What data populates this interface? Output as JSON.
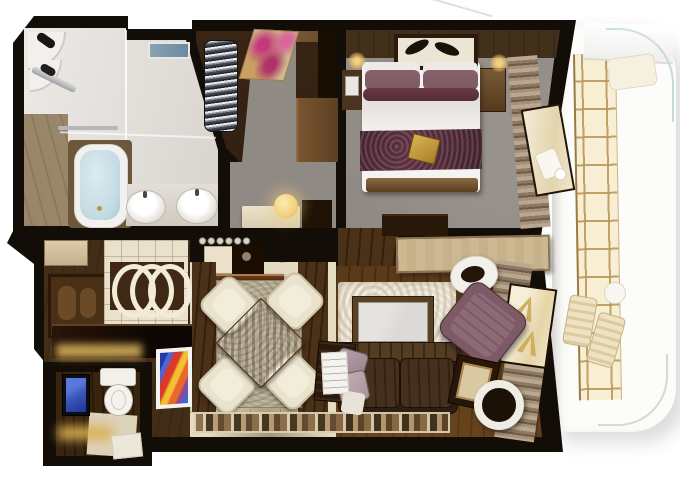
{
  "scene": {
    "description": "Top-down 3D rendered floor plan of a suite stateroom with private balcony; no text labels rendered",
    "background": "#ffffff"
  },
  "palette": {
    "wall": "#130d08",
    "marble": "#e9e5e1",
    "marble_dark": "#d8d3cd",
    "bath_wood": "#9a8668",
    "water": "#c3dae2",
    "closet_floor": "#2b1c10",
    "rug_pink": "#c23a78",
    "rug_gold": "#cdb78c",
    "carpet": "#908a85",
    "headwall": "#3b2a16",
    "bed_white": "#f5f3f0",
    "bed_runner": "#5d3040",
    "pillow_mauve": "#7d5b62",
    "sconce": "#f2d27c",
    "credenza": "#cdb894",
    "wood_floor": "#3a2715",
    "wood_floor_light": "#4a3118",
    "tile": "#e5dbc1",
    "tile_wall": "#eae1cd",
    "lattice_bg": "#3f2814",
    "cream": "#e9e2cd",
    "table_wood": "#7a5838",
    "sofa": "#2e1f12",
    "plum": "#7d5a66",
    "tv_screen": "#dcdad6",
    "balcony_gold": "#b9975a",
    "balcony_glass_bg": "#f8eed4",
    "deck_white": "#fcfcfa",
    "glow_gold": "#dcb65e",
    "wc_blue": "#3b55b8",
    "art_red": "#d93a2a",
    "art_blue": "#2438a8",
    "art_yellow": "#f2c12e",
    "mosaic_brown": "#8a6b46"
  },
  "rooms": [
    {
      "name": "master-bathroom",
      "label": "Master bathroom",
      "features": [
        "corner shower shelves",
        "shower head bar",
        "glass partition",
        "skylight",
        "bathtub",
        "double round sinks",
        "teak floor strip",
        "towel bar"
      ]
    },
    {
      "name": "walk-in-closet",
      "label": "Walk-in closet",
      "features": [
        "spiral clothes rack",
        "pink patterned rug",
        "wardrobe cabinet"
      ]
    },
    {
      "name": "entry-corridor",
      "label": "Entry corridor",
      "features": [
        "cream console",
        "glowing sphere lamp",
        "cabinet"
      ]
    },
    {
      "name": "master-bedroom",
      "label": "Master bedroom",
      "features": [
        "king bed with burgundy runner",
        "headboard wall",
        "ceiling leaf panel",
        "two wall sconces",
        "two nightstands",
        "foot dresser",
        "curtains",
        "balcony window"
      ]
    },
    {
      "name": "bar-kitchenette",
      "label": "Bar / kitchenette",
      "features": [
        "tan cabinet",
        "wood art panel",
        "tile wall with ring lattice",
        "buffet with espresso machine",
        "glossy bar counter with gold underglow",
        "colorful abstract artwork"
      ]
    },
    {
      "name": "dining-area",
      "label": "Dining area",
      "features": [
        "square walnut table rotated 45deg",
        "four cream chairs",
        "area rug",
        "mosaic runner rug"
      ]
    },
    {
      "name": "living-room",
      "label": "Living room",
      "features": [
        "stone TV wall with wall TV",
        "dark slatted sofa with mauve pillows",
        "plum armchair",
        "end table with framed art",
        "round tray table",
        "white desk chair",
        "curtains",
        "balcony window"
      ]
    },
    {
      "name": "guest-wc",
      "label": "Guest WC",
      "features": [
        "wall TV with blue screen",
        "toilet",
        "lit floor strip",
        "door"
      ]
    },
    {
      "name": "balcony",
      "label": "Private balcony",
      "features": [
        "gold-framed glass wall",
        "privacy partition",
        "curved glass balustrade",
        "two deck chairs",
        "round deck table",
        "lounger"
      ]
    }
  ]
}
